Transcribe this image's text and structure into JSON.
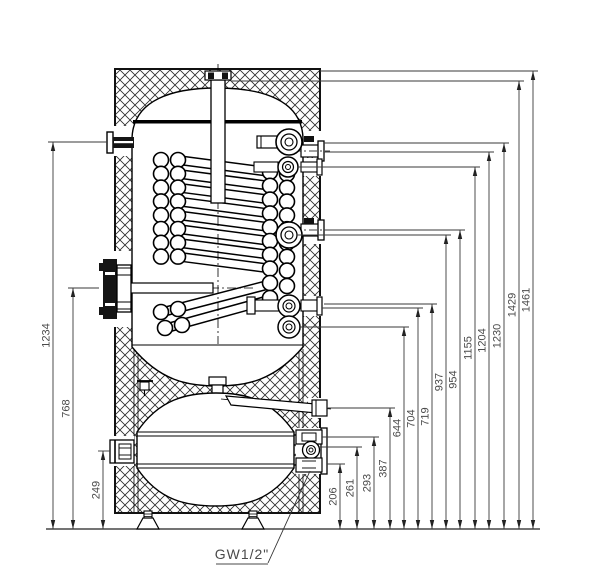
{
  "drawing": {
    "subject": "storage-tank-with-coil-heat-exchanger-cross-section",
    "port_label": "GW1/2\"",
    "dim_color": "#4a4a4a",
    "line_color": "#000000",
    "baseline_y": 529,
    "px_per_mm": 0.3135,
    "left_dimensions": [
      {
        "value": "1234",
        "line_x": 53,
        "ext_x": 107
      },
      {
        "value": "768",
        "line_x": 73,
        "ext_x": 99
      },
      {
        "value": "249",
        "line_x": 103,
        "ext_x": 110
      }
    ],
    "right_dimensions": [
      {
        "value": "206",
        "line_x": 340,
        "ext_x": 327
      },
      {
        "value": "261",
        "line_x": 357,
        "ext_x": 319
      },
      {
        "value": "293",
        "line_x": 374,
        "ext_x": 322
      },
      {
        "value": "387",
        "line_x": 390,
        "ext_x": 327
      },
      {
        "value": "644",
        "line_x": 404,
        "ext_x": 300
      },
      {
        "value": "704",
        "line_x": 418,
        "ext_x": 322
      },
      {
        "value": "719",
        "line_x": 432,
        "ext_x": 324
      },
      {
        "value": "937",
        "line_x": 446,
        "ext_x": 297
      },
      {
        "value": "954",
        "line_x": 460,
        "ext_x": 324
      },
      {
        "value": "1155",
        "line_x": 475,
        "ext_x": 298
      },
      {
        "value": "1204",
        "line_x": 489,
        "ext_x": 324
      },
      {
        "value": "1230",
        "line_x": 504,
        "ext_x": 324
      },
      {
        "value": "1429",
        "line_x": 519,
        "ext_x": 232
      },
      {
        "value": "1461",
        "line_x": 533,
        "ext_x": 320
      }
    ]
  }
}
